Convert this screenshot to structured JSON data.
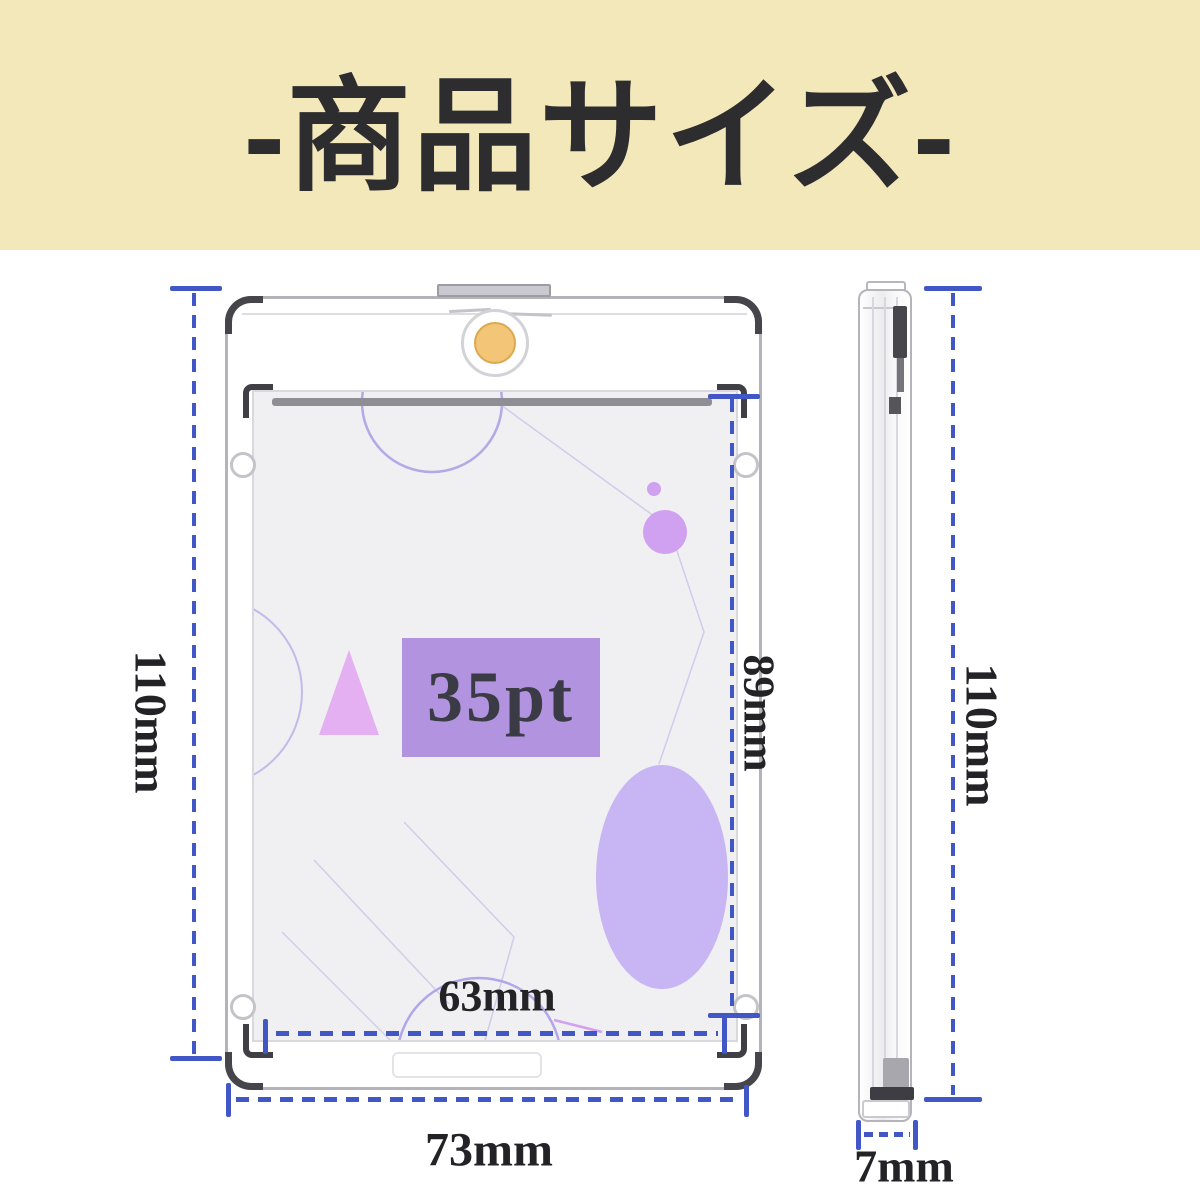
{
  "banner": {
    "title": "-商品サイズ-"
  },
  "front_view": {
    "card_label": "35pt",
    "dimensions": {
      "outer_height": "110mm",
      "inner_height": "89mm",
      "inner_width": "63mm",
      "outer_width": "73mm"
    }
  },
  "side_view": {
    "dimensions": {
      "height": "110mm",
      "thickness": "7mm"
    }
  },
  "colors": {
    "accent_blue": "#4157c5",
    "banner_bg": "#f3e8ba",
    "title_ink": "#2d2d30",
    "label_ink": "#232327",
    "magnet_gold": "#f2c577",
    "card_label_bg": "#b193e0",
    "decor_purple": "#c8b5f3"
  }
}
